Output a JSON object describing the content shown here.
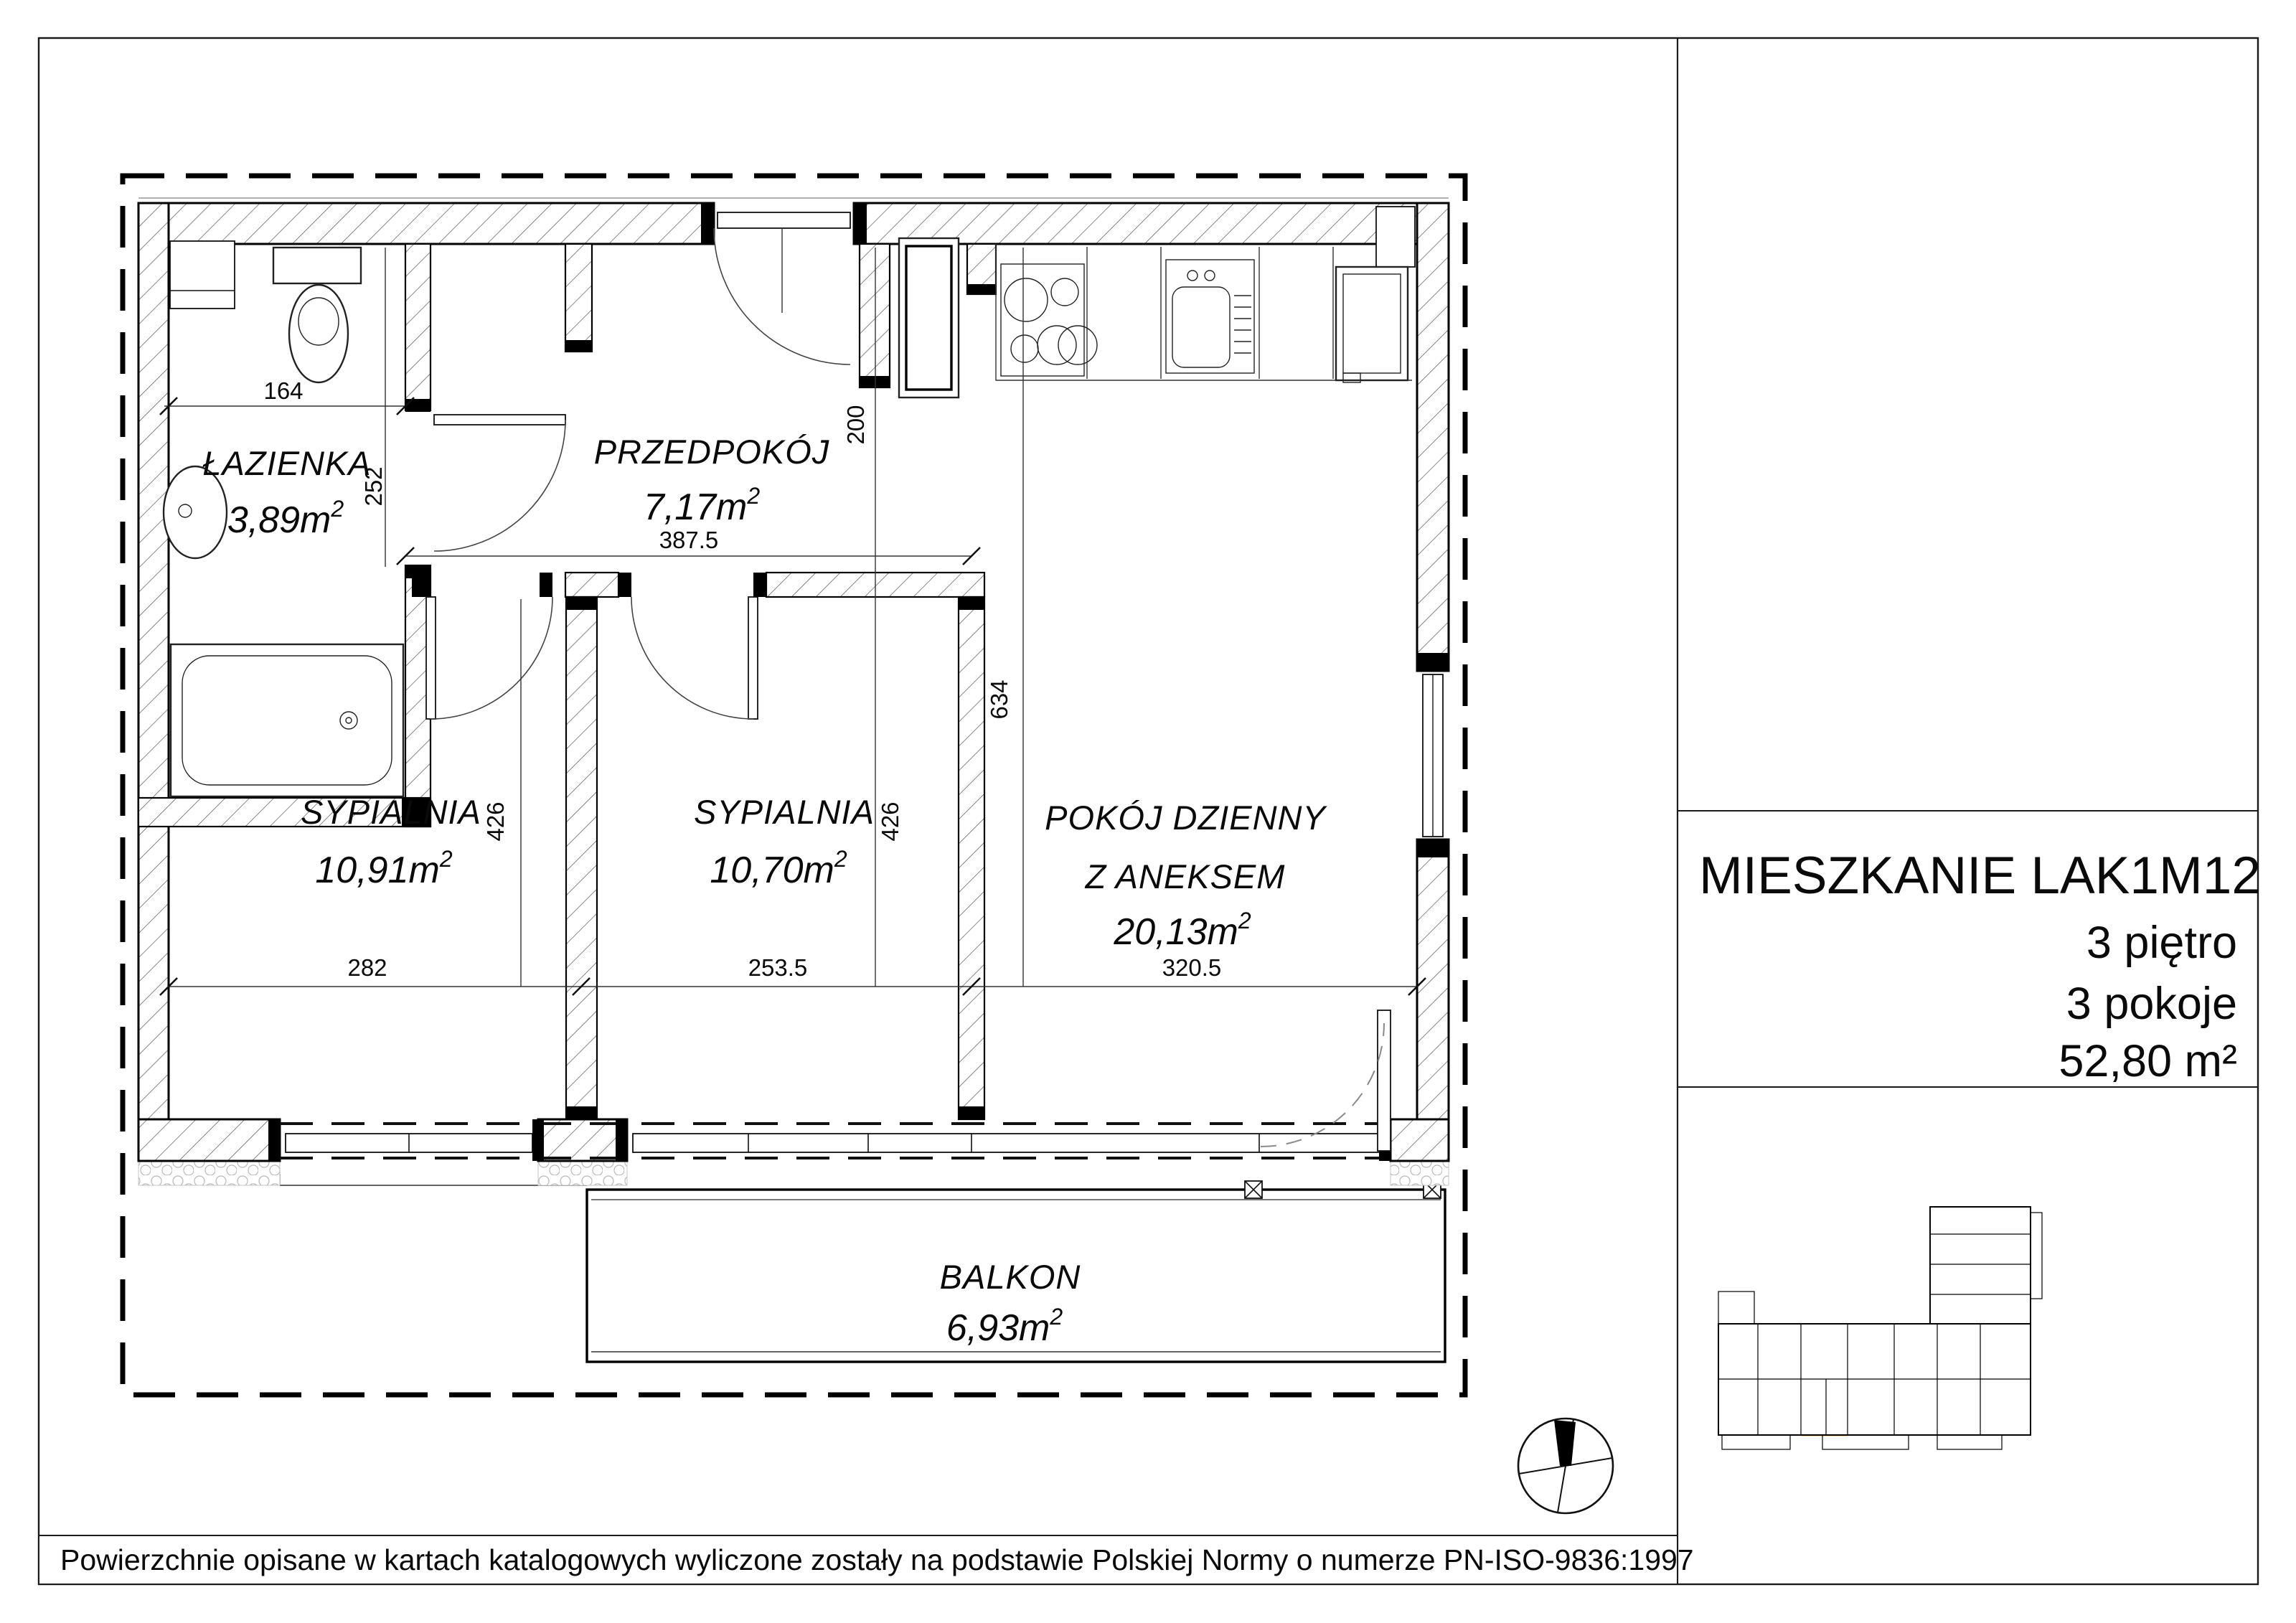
{
  "panel": {
    "title": "MIESZKANIE LAK1M12",
    "floor": "3 piętro",
    "rooms_count": "3 pokoje",
    "total_area": "52,80 m²"
  },
  "disclaimer": "Powierzchnie opisane w kartach katalogowych wyliczone zostały na podstawie  Polskiej Normy o numerze PN-ISO-9836:1997",
  "sup": "2",
  "rooms": {
    "bathroom": {
      "name": "ŁAZIENKA",
      "area": "3,89m"
    },
    "hall": {
      "name": "PRZEDPOKÓJ",
      "area": "7,17m"
    },
    "bedroom1": {
      "name": "SYPIALNIA",
      "area": "10,91m"
    },
    "bedroom2": {
      "name": "SYPIALNIA",
      "area": "10,70m"
    },
    "living": {
      "name": "POKÓJ  DZIENNY",
      "name2": "Z  ANEKSEM",
      "area": "20,13m"
    },
    "balcony": {
      "name": "BALKON",
      "area": "6,93m"
    }
  },
  "dimensions": {
    "bath_w": "164",
    "bath_h": "252",
    "hall_w": "387.5",
    "hall_h": "200",
    "living_h": "634",
    "bed1_h": "426",
    "bed2_h": "426",
    "bed1_w": "282",
    "bed2_w": "253.5",
    "living_w": "320.5"
  },
  "colors": {
    "highlight": "#f8d8a8",
    "ink": "#000000"
  }
}
